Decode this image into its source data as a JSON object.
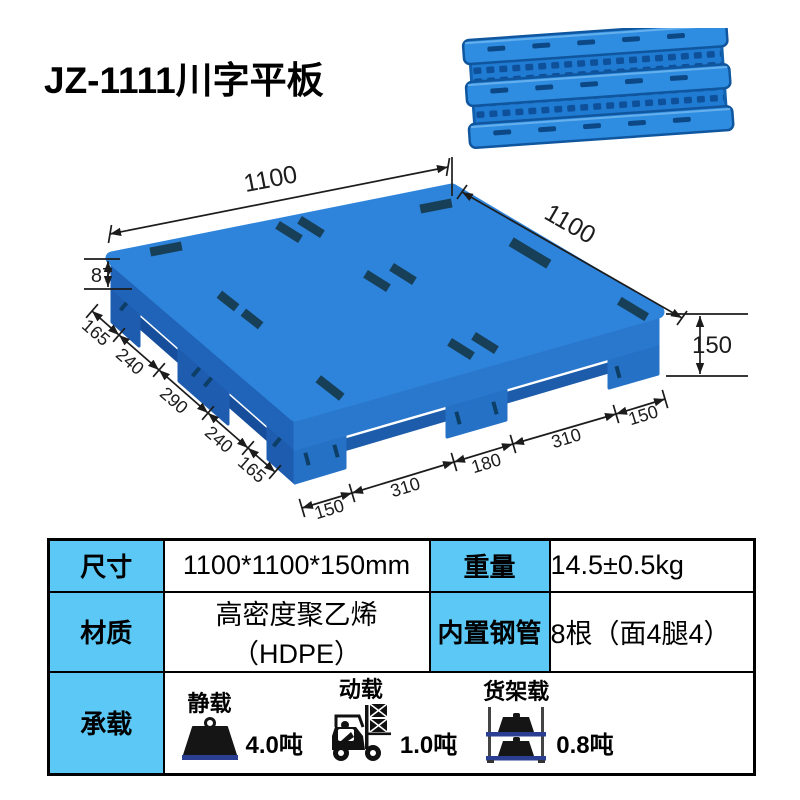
{
  "page": {
    "title": "JZ-1111川字平板"
  },
  "colors": {
    "pallet_blue": "#2e84da",
    "pallet_left_band": "#2064ba",
    "pallet_right_band": "#2a78cd",
    "slot_dark": "#173f58",
    "table_header_blue": "#5cc8f5",
    "dimension_line": "#1c1c1c",
    "load_base_navy": "#2a3f92"
  },
  "drawing": {
    "top_left_length": "1100",
    "top_right_length": "1100",
    "deck_thickness": "87",
    "overall_height": "150",
    "left_edge_segments": [
      "165",
      "240",
      "290",
      "240",
      "165"
    ],
    "front_edge_segments": [
      "150",
      "310",
      "180",
      "310",
      "150"
    ]
  },
  "table": {
    "rows": [
      {
        "h1": "尺寸",
        "v1": "1100*1100*150mm",
        "h2": "重量",
        "v2": "14.5±0.5kg"
      },
      {
        "h1": "材质",
        "v1": "高密度聚乙烯（HDPE）",
        "h2": "内置钢管",
        "v2": "8根（面4腿4）"
      }
    ],
    "load": {
      "header": "承载",
      "items": [
        {
          "label": "静载",
          "value": "4.0吨",
          "icon": "weight-icon"
        },
        {
          "label": "动载",
          "value": "1.0吨",
          "icon": "forklift-icon"
        },
        {
          "label": "货架载",
          "value": "0.8吨",
          "icon": "rack-icon"
        }
      ]
    }
  }
}
